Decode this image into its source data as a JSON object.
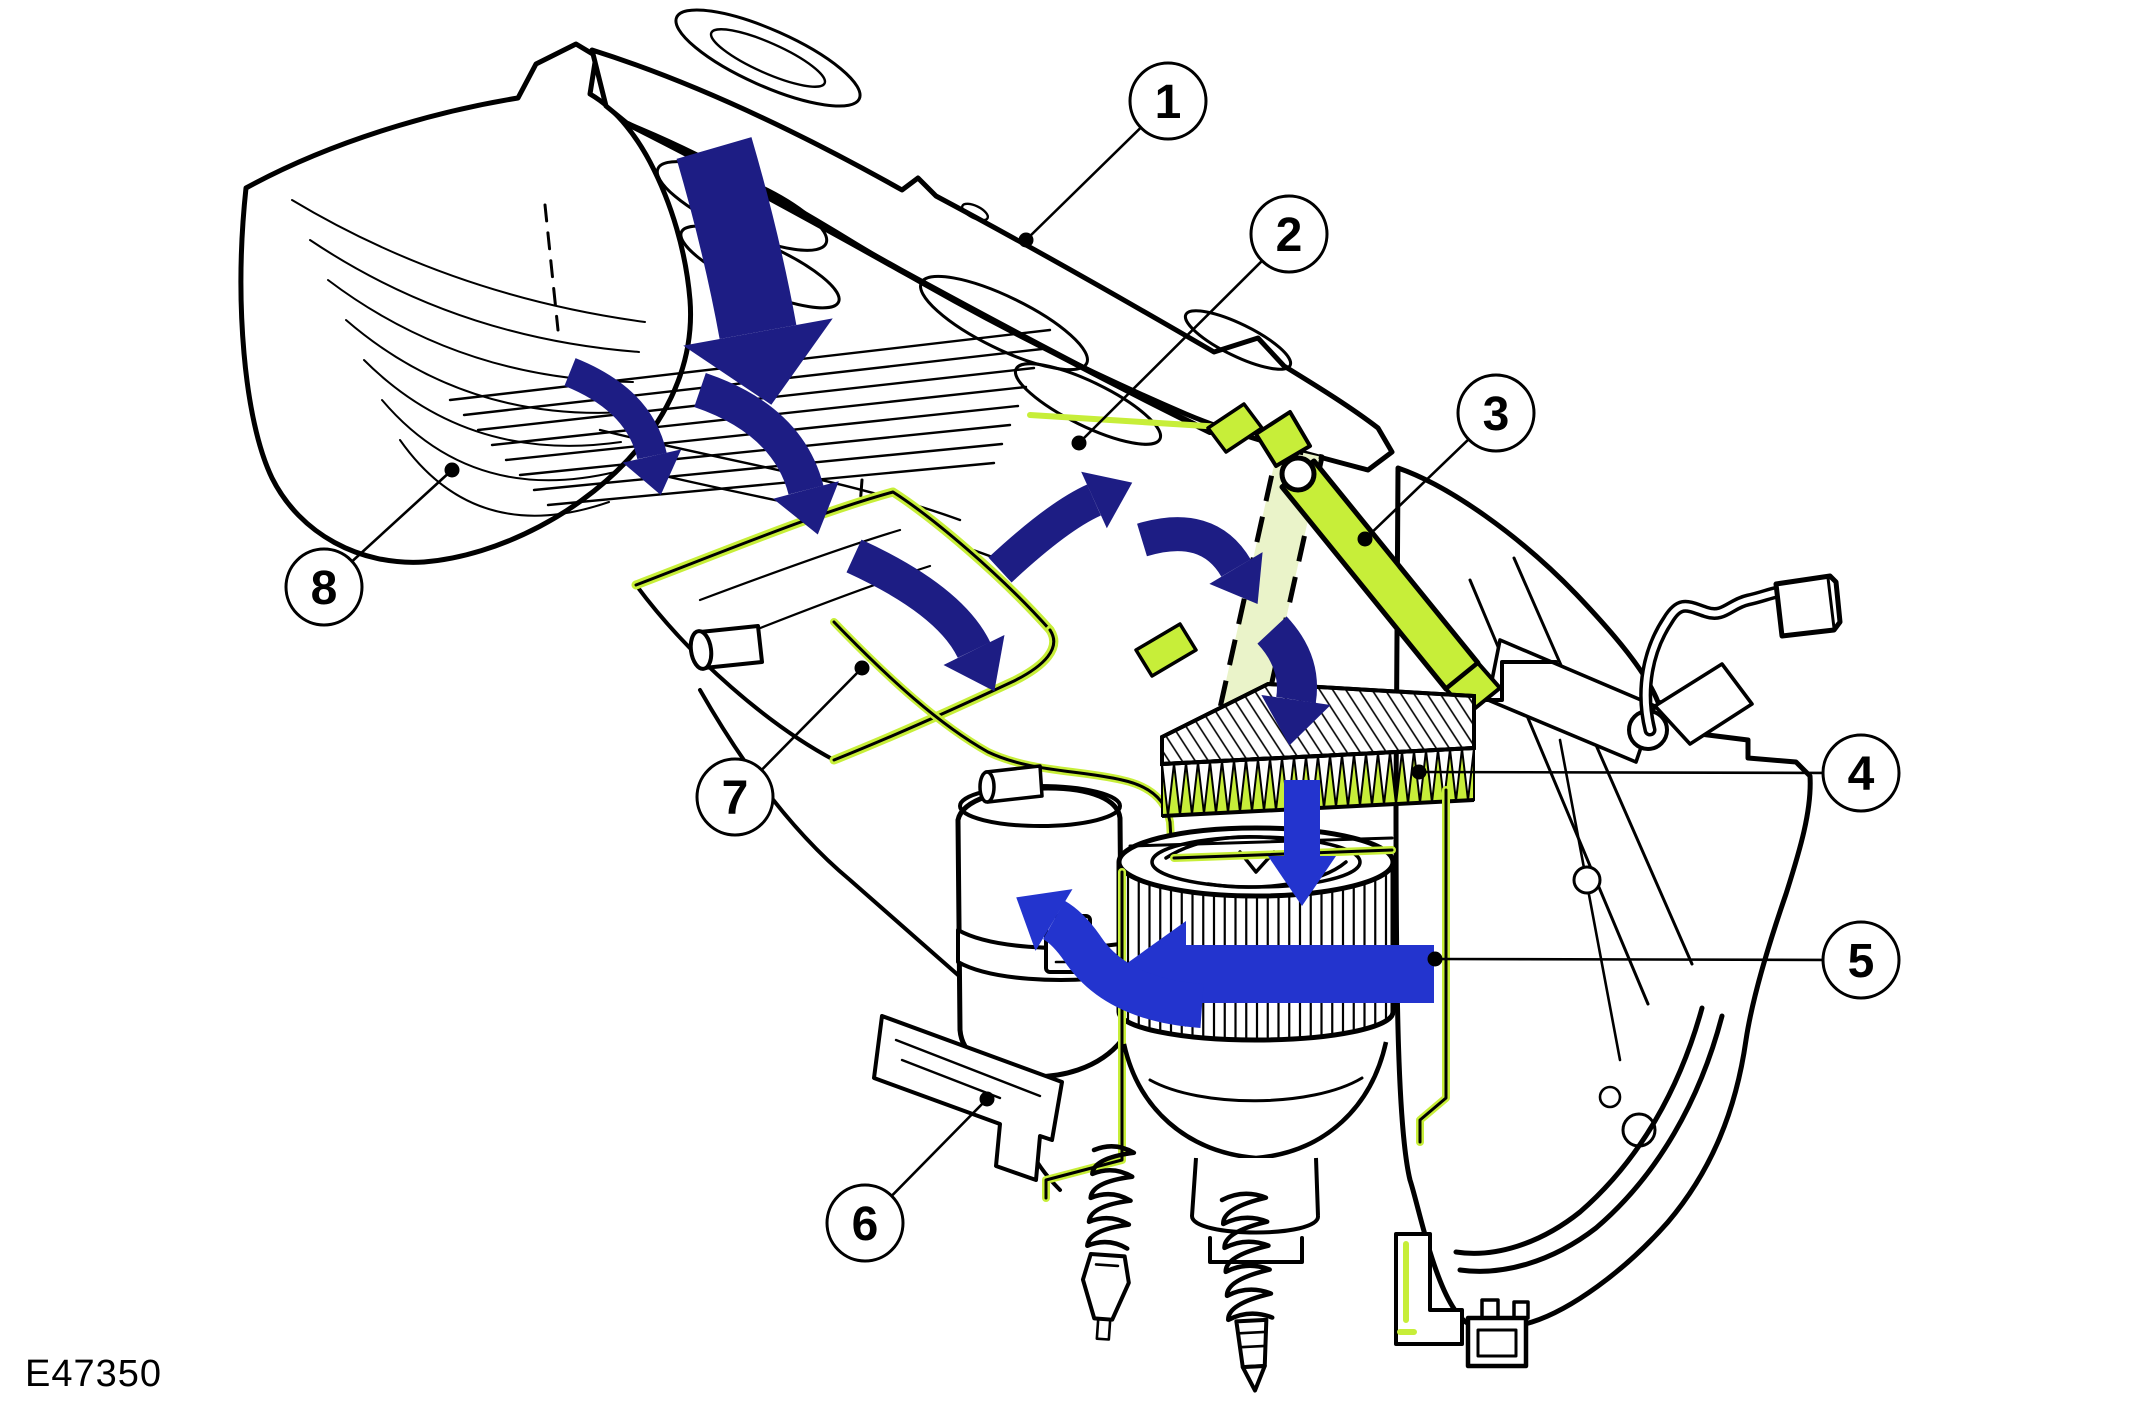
{
  "figure": {
    "code": "E47350"
  },
  "colors": {
    "line": "#000000",
    "background": "#ffffff",
    "seal_green": "#c7ee39",
    "pale_green": "#eaf3c9",
    "arrow_navy": "#1d1d84",
    "arrow_blue": "#2334ce"
  },
  "callouts": {
    "style": {
      "radius": 38,
      "dot_radius": 7.5
    },
    "items": [
      {
        "label": "1",
        "cx": 1168,
        "cy": 101,
        "tx": 1026,
        "ty": 240
      },
      {
        "label": "2",
        "cx": 1289,
        "cy": 234,
        "tx": 1079,
        "ty": 443
      },
      {
        "label": "3",
        "cx": 1496,
        "cy": 413,
        "tx": 1365,
        "ty": 539
      },
      {
        "label": "4",
        "cx": 1861,
        "cy": 773,
        "tx": 1419,
        "ty": 772
      },
      {
        "label": "5",
        "cx": 1861,
        "cy": 960,
        "tx": 1435,
        "ty": 959
      },
      {
        "label": "6",
        "cx": 865,
        "cy": 1223,
        "tx": 987,
        "ty": 1099
      },
      {
        "label": "7",
        "cx": 735,
        "cy": 797,
        "tx": 862,
        "ty": 668
      },
      {
        "label": "8",
        "cx": 324,
        "cy": 587,
        "tx": 452,
        "ty": 470
      }
    ]
  },
  "airflow_arrows": [
    {
      "name": "intake-down-arrow",
      "color": "arrow_navy",
      "d": "M714,148 Q742,244 758,332",
      "shaft": 78,
      "head_l": 74,
      "head_w": 152
    },
    {
      "name": "grille-flow-arrow-1",
      "color": "arrow_navy",
      "d": "M570,372 Q640,400 652,456",
      "shaft": 30,
      "head_l": 40,
      "head_w": 60
    },
    {
      "name": "grille-flow-arrow-2",
      "color": "arrow_navy",
      "d": "M700,390 Q788,420 806,490",
      "shaft": 36,
      "head_l": 46,
      "head_w": 68
    },
    {
      "name": "plenum-down-arrow",
      "color": "arrow_navy",
      "d": "M854,556 Q950,600 974,650",
      "shaft": 36,
      "head_l": 46,
      "head_w": 68
    },
    {
      "name": "plenum-up-arrow",
      "color": "arrow_navy",
      "d": "M1000,570 Q1058,516 1094,500",
      "shaft": 34,
      "head_l": 42,
      "head_w": 62
    },
    {
      "name": "filter-inlet-arrow",
      "color": "arrow_navy",
      "d": "M1142,540 Q1208,520 1236,568",
      "shaft": 34,
      "head_l": 42,
      "head_w": 62
    },
    {
      "name": "filter-down-arrow",
      "color": "arrow_navy",
      "d": "M1272,630 Q1302,662 1296,700",
      "shaft": 40,
      "head_l": 46,
      "head_w": 70
    },
    {
      "name": "wheel-inlet-arrow",
      "color": "arrow_blue",
      "d": "M1302,780 L1302,856",
      "shaft": 36,
      "head_l": 50,
      "head_w": 68
    },
    {
      "name": "wheel-discharge-arrow",
      "color": "arrow_blue",
      "d": "M1434,974 L1186,974",
      "shaft": 58,
      "head_l": 74,
      "head_w": 106
    },
    {
      "name": "wheel-wrap-arrow",
      "color": "arrow_blue",
      "d": "M1202,1006 Q1116,1000 1082,948 Q1068,928 1054,920",
      "shaft": 44,
      "head_l": 44,
      "head_w": 72
    }
  ]
}
